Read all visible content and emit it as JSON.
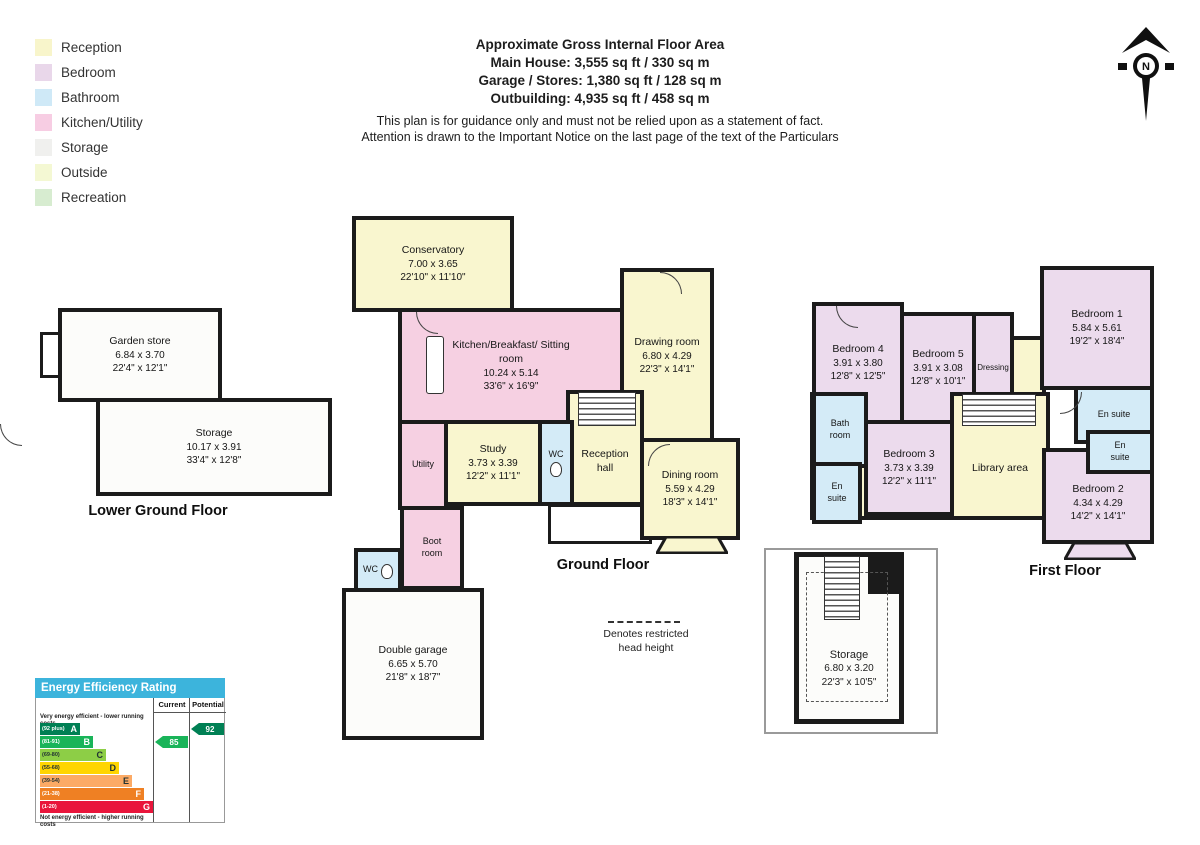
{
  "header": {
    "line1": "Approximate Gross Internal Floor Area",
    "line2": "Main House: 3,555 sq ft / 330 sq m",
    "line3": "Garage / Stores: 1,380 sq ft / 128 sq m",
    "line4": "Outbuilding: 4,935 sq ft / 458 sq m",
    "disclaimer1": "This plan is for guidance only and must not be relied upon as a statement of fact.",
    "disclaimer2": "Attention is drawn to the Important Notice on the last page of the text of the Particulars"
  },
  "legend": {
    "items": [
      {
        "label": "Reception",
        "color": "#f8f5cb"
      },
      {
        "label": "Bedroom",
        "color": "#e9d7ea"
      },
      {
        "label": "Bathroom",
        "color": "#cfe9f7"
      },
      {
        "label": "Kitchen/Utility",
        "color": "#f7cde3"
      },
      {
        "label": "Storage",
        "color": "#f0f0ee"
      },
      {
        "label": "Outside",
        "color": "#f4f8d3"
      },
      {
        "label": "Recreation",
        "color": "#d7ecd0"
      }
    ]
  },
  "north": {
    "label": "N"
  },
  "floors": {
    "lower_ground": {
      "label": "Lower Ground Floor",
      "rooms": [
        {
          "name": "Garden store",
          "dims_m": "6.84 x 3.70",
          "dims_ft": "22'4\" x 12'1\""
        },
        {
          "name": "Storage",
          "dims_m": "10.17 x 3.91",
          "dims_ft": "33'4\" x 12'8\""
        }
      ]
    },
    "ground": {
      "label": "Ground Floor",
      "rooms": [
        {
          "name": "Conservatory",
          "dims_m": "7.00 x 3.65",
          "dims_ft": "22'10\" x 11'10\""
        },
        {
          "name": "Kitchen/Breakfast/ Sitting room",
          "dims_m": "10.24 x 5.14",
          "dims_ft": "33'6\" x 16'9\""
        },
        {
          "name": "Drawing room",
          "dims_m": "6.80 x 4.29",
          "dims_ft": "22'3\" x 14'1\""
        },
        {
          "name": "Study",
          "dims_m": "3.73 x 3.39",
          "dims_ft": "12'2\" x 11'1\""
        },
        {
          "name": "WC"
        },
        {
          "name": "Reception hall"
        },
        {
          "name": "Dining room",
          "dims_m": "5.59 x 4.29",
          "dims_ft": "18'3\" x 14'1\""
        },
        {
          "name": "Utility"
        },
        {
          "name": "Boot room"
        },
        {
          "name": "WC"
        },
        {
          "name": "Double garage",
          "dims_m": "6.65 x 5.70",
          "dims_ft": "21'8\" x 18'7\""
        }
      ]
    },
    "first": {
      "label": "First Floor",
      "rooms": [
        {
          "name": "Bedroom 4",
          "dims_m": "3.91 x 3.80",
          "dims_ft": "12'8\" x 12'5\""
        },
        {
          "name": "Bedroom 5",
          "dims_m": "3.91 x 3.08",
          "dims_ft": "12'8\" x 10'1\""
        },
        {
          "name": "Dressing"
        },
        {
          "name": "Bedroom 1",
          "dims_m": "5.84 x 5.61",
          "dims_ft": "19'2\" x 18'4\""
        },
        {
          "name": "En suite"
        },
        {
          "name": "Bath room"
        },
        {
          "name": "En suite"
        },
        {
          "name": "Bedroom 3",
          "dims_m": "3.73 x 3.39",
          "dims_ft": "12'2\" x 11'1\""
        },
        {
          "name": "Library area"
        },
        {
          "name": "En suite"
        },
        {
          "name": "Bedroom 2",
          "dims_m": "4.34 x 4.29",
          "dims_ft": "14'2\" x 14'1\""
        }
      ]
    },
    "outbuilding": {
      "rooms": [
        {
          "name": "Storage",
          "dims_m": "6.80 x 3.20",
          "dims_ft": "22'3\" x 10'5\""
        }
      ]
    }
  },
  "note": {
    "line1": "Denotes restricted",
    "line2": "head height"
  },
  "eer": {
    "title": "Energy Efficiency Rating",
    "columns": {
      "current": "Current",
      "potential": "Potential"
    },
    "top_caption": "Very energy efficient - lower running costs",
    "bottom_caption": "Not energy efficient - higher running costs",
    "bands": [
      {
        "range": "(92 plus)",
        "letter": "A",
        "color": "#008054"
      },
      {
        "range": "(81-91)",
        "letter": "B",
        "color": "#19b459"
      },
      {
        "range": "(69-80)",
        "letter": "C",
        "color": "#8dce46"
      },
      {
        "range": "(55-68)",
        "letter": "D",
        "color": "#ffd500"
      },
      {
        "range": "(39-54)",
        "letter": "E",
        "color": "#fcaa65"
      },
      {
        "range": "(21-38)",
        "letter": "F",
        "color": "#ef8023"
      },
      {
        "range": "(1-20)",
        "letter": "G",
        "color": "#e9153b"
      }
    ],
    "current": {
      "value": "85",
      "color": "#19b459"
    },
    "potential": {
      "value": "92",
      "color": "#008054"
    }
  }
}
